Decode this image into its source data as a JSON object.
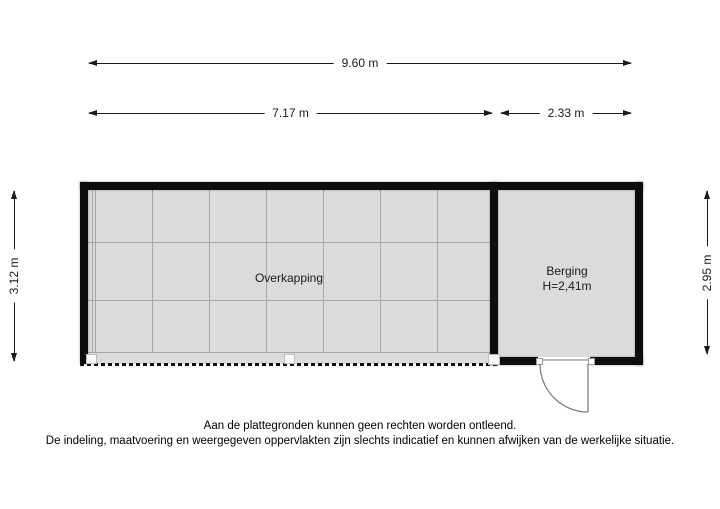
{
  "floorplan": {
    "rooms": {
      "overkapping": {
        "label": "Overkapping"
      },
      "berging": {
        "label": "Berging",
        "ceiling_height": "H=2,41m"
      }
    },
    "dimensions": {
      "total_width": "9.60 m",
      "overkapping_width": "7.17 m",
      "berging_width": "2.33 m",
      "overkapping_depth": "3.12 m",
      "berging_depth": "2.95 m"
    }
  },
  "disclaimer": {
    "line1": "Aan de plattegronden kunnen geen rechten worden ontleend.",
    "line2": "De indeling, maatvoering en weergegeven oppervlakten zijn slechts indicatief en kunnen afwijken van de werkelijke situatie."
  },
  "colors": {
    "wall": "#0d0d0d",
    "floor": "#dcdcdc",
    "grid_line": "#a6a6a6",
    "dimension_line": "#1a1a1a"
  }
}
